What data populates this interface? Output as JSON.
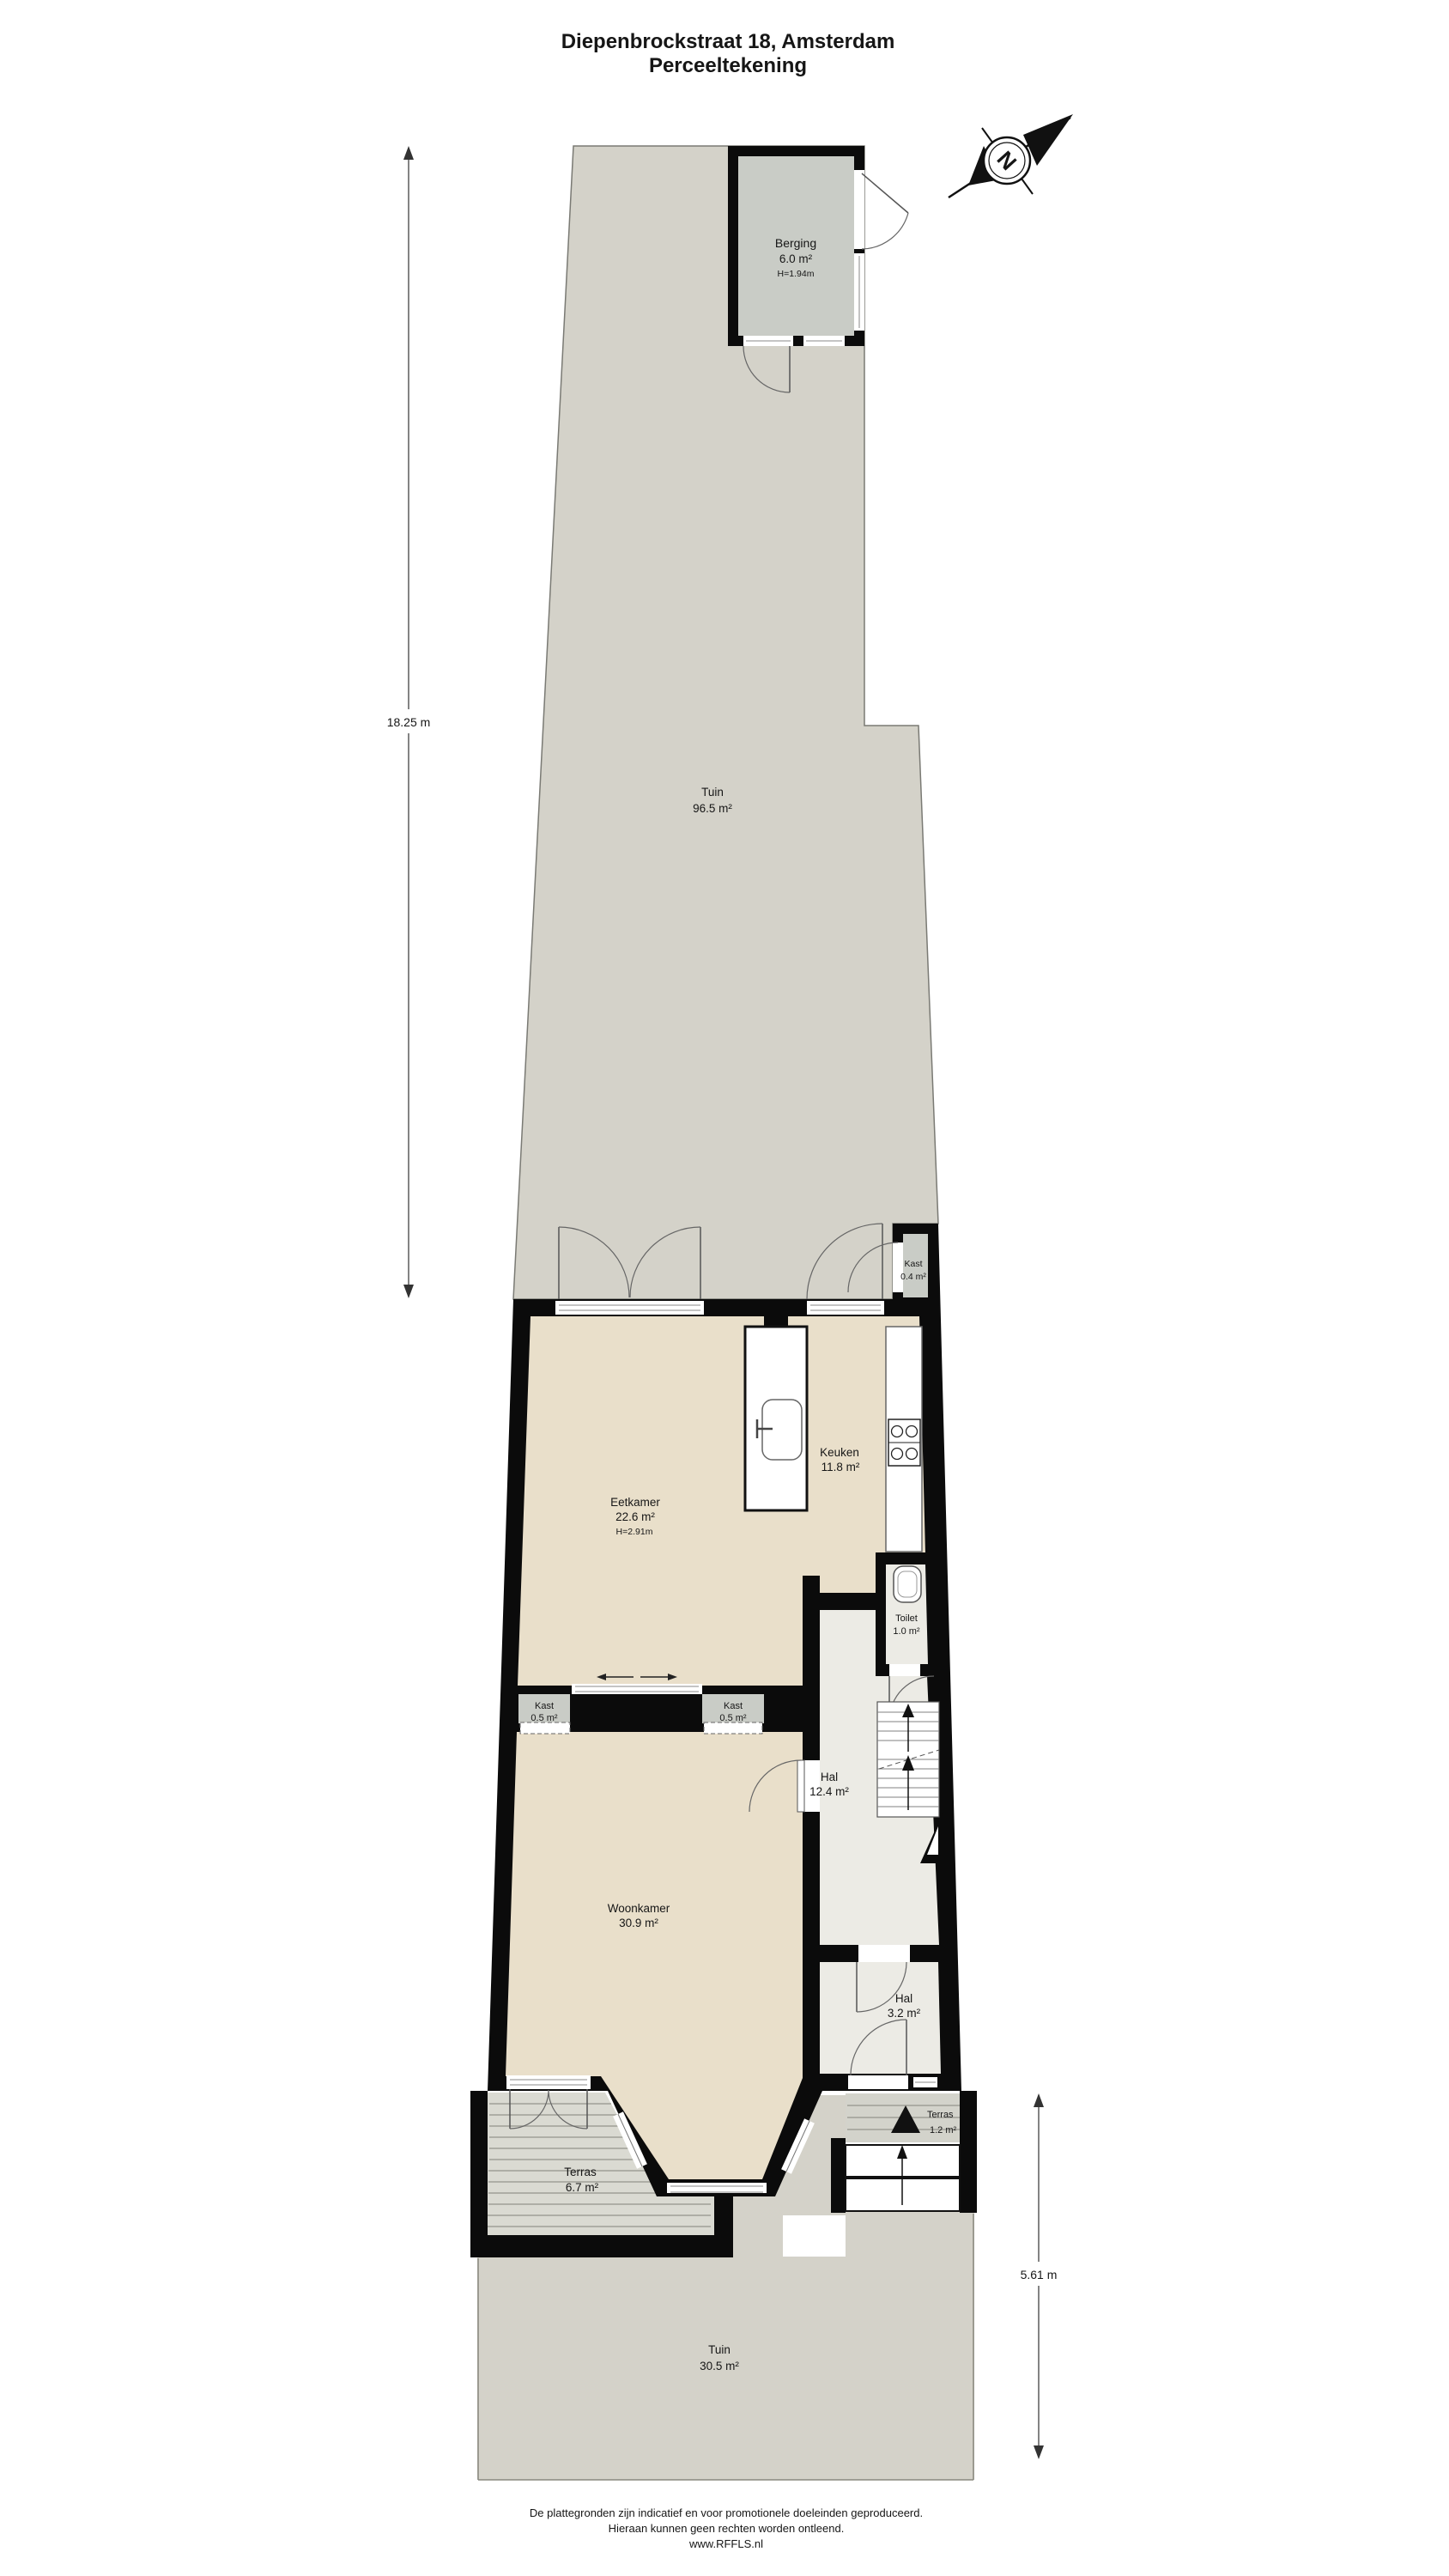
{
  "title": {
    "line1": "Diepenbrockstraat 18, Amsterdam",
    "line2": "Perceeltekening"
  },
  "compass": {
    "north_letter": "N"
  },
  "dimensions": {
    "plot_length": "18.25 m",
    "garden_depth": "5.61 m"
  },
  "rooms": {
    "tuin_boven": {
      "name": "Tuin",
      "area": "96.5 m²"
    },
    "berging": {
      "name": "Berging",
      "area": "6.0 m²",
      "height": "H=1.94m"
    },
    "kast_tuin": {
      "name": "Kast",
      "area": "0.4 m²"
    },
    "eetkamer": {
      "name": "Eetkamer",
      "area": "22.6 m²",
      "height": "H=2.91m"
    },
    "keuken": {
      "name": "Keuken",
      "area": "11.8 m²"
    },
    "toilet": {
      "name": "Toilet",
      "area": "1.0 m²"
    },
    "kast_links": {
      "name": "Kast",
      "area": "0.5 m²"
    },
    "kast_rechts": {
      "name": "Kast",
      "area": "0.5 m²"
    },
    "hal": {
      "name": "Hal",
      "area": "12.4 m²"
    },
    "woonkamer": {
      "name": "Woonkamer",
      "area": "30.9 m²"
    },
    "hal_entree": {
      "name": "Hal",
      "area": "3.2 m²"
    },
    "terras_voor": {
      "name": "Terras",
      "area": "1.2 m²"
    },
    "terras_achter": {
      "name": "Terras",
      "area": "6.7 m²"
    },
    "tuin_onder": {
      "name": "Tuin",
      "area": "30.5 m²"
    }
  },
  "footer": {
    "line1": "De plattegronden zijn indicatief en voor promotionele doeleinden geproduceerd.",
    "line2": "Hieraan kunnen geen rechten worden ontleend.",
    "line3": "www.RFFLS.nl"
  },
  "colors": {
    "garden": "#d4d2c9",
    "floor_living": "#e9dfca",
    "floor_hall": "#ecebe5",
    "storage": "#c9ccc6",
    "deck": "#dadad2",
    "wall": "#0b0b0b"
  }
}
